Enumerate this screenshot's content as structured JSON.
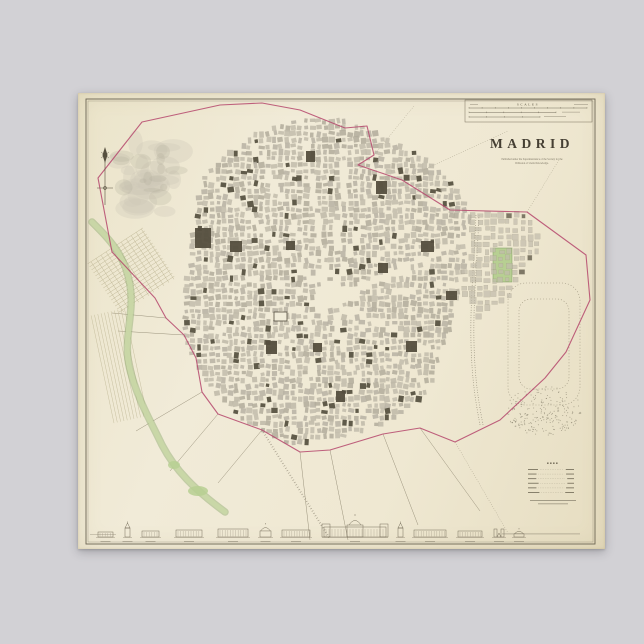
{
  "backdrop_color": "#d2d1d5",
  "poster": {
    "title": "MADRID",
    "imprint_lines": [
      "Published under the Superintendence of the Society for the",
      "Diffusion of Useful Knowledge."
    ],
    "scales_label": "SCALES",
    "legend_rows": 6,
    "colors": {
      "paper": "#f0ead5",
      "paper_edge": "#e6ddc2",
      "ink": "#57503f",
      "frame": "#6b6453",
      "title_ink": "#453f33",
      "boundary_pink": "#b5476c",
      "river_green": "#c9d7a6",
      "river_edge_green": "#94ad74",
      "park_green": "#b7cf92",
      "park_edge_green": "#7f9d62",
      "block_grays": [
        "#b7b2a3",
        "#beb8a8",
        "#b1ab9b",
        "#c2bcac"
      ],
      "block_dark": "#544e3e",
      "street": "#f1ecd9",
      "road": "#9a927c",
      "hill_light": "#cdc8b8",
      "hill_dark": "#b3ad9c",
      "greek": "#8a8270"
    }
  }
}
